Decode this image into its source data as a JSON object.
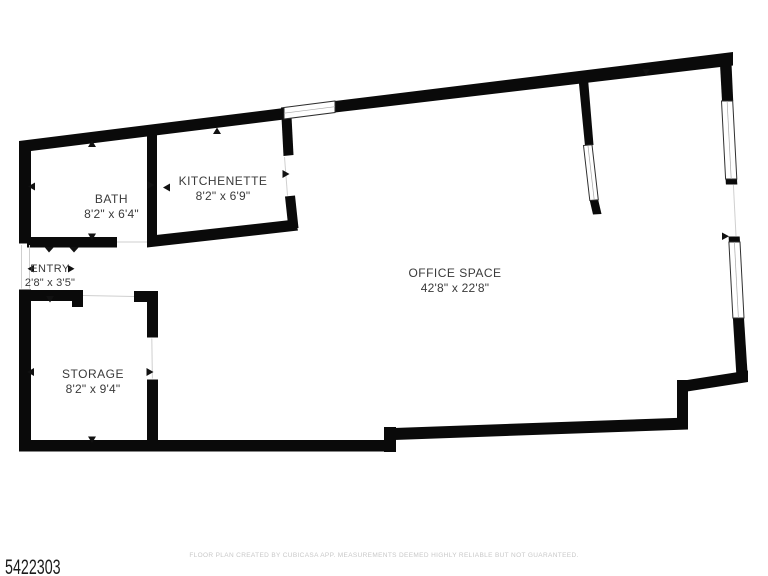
{
  "rooms": {
    "bath": {
      "name": "BATH",
      "dims": "8'2\" x 6'4\""
    },
    "kitchenette": {
      "name": "KITCHENETTE",
      "dims": "8'2\" x 6'9\""
    },
    "entry": {
      "name": "ENTRY",
      "dims": "2'8\" x 3'5\""
    },
    "storage": {
      "name": "STORAGE",
      "dims": "8'2\" x 9'4\""
    },
    "office": {
      "name": "OFFICE SPACE",
      "dims": "42'8\" x 22'8\""
    }
  },
  "footer": {
    "disclaimer": "FLOOR PLAN CREATED BY CUBICASA APP. MEASUREMENTS DEEMED HIGHLY RELIABLE BUT NOT GUARANTEED."
  },
  "listing_id": "5422303",
  "colors": {
    "background": "#ffffff",
    "wall": "#0a0a0a",
    "label": "#3a3a3a",
    "marker": "#111111",
    "window_stroke": "#2f2f2f",
    "opening_line": "#cfcfcf",
    "footer_text": "#c8c8c8",
    "id_text": "#1b1b1b"
  }
}
